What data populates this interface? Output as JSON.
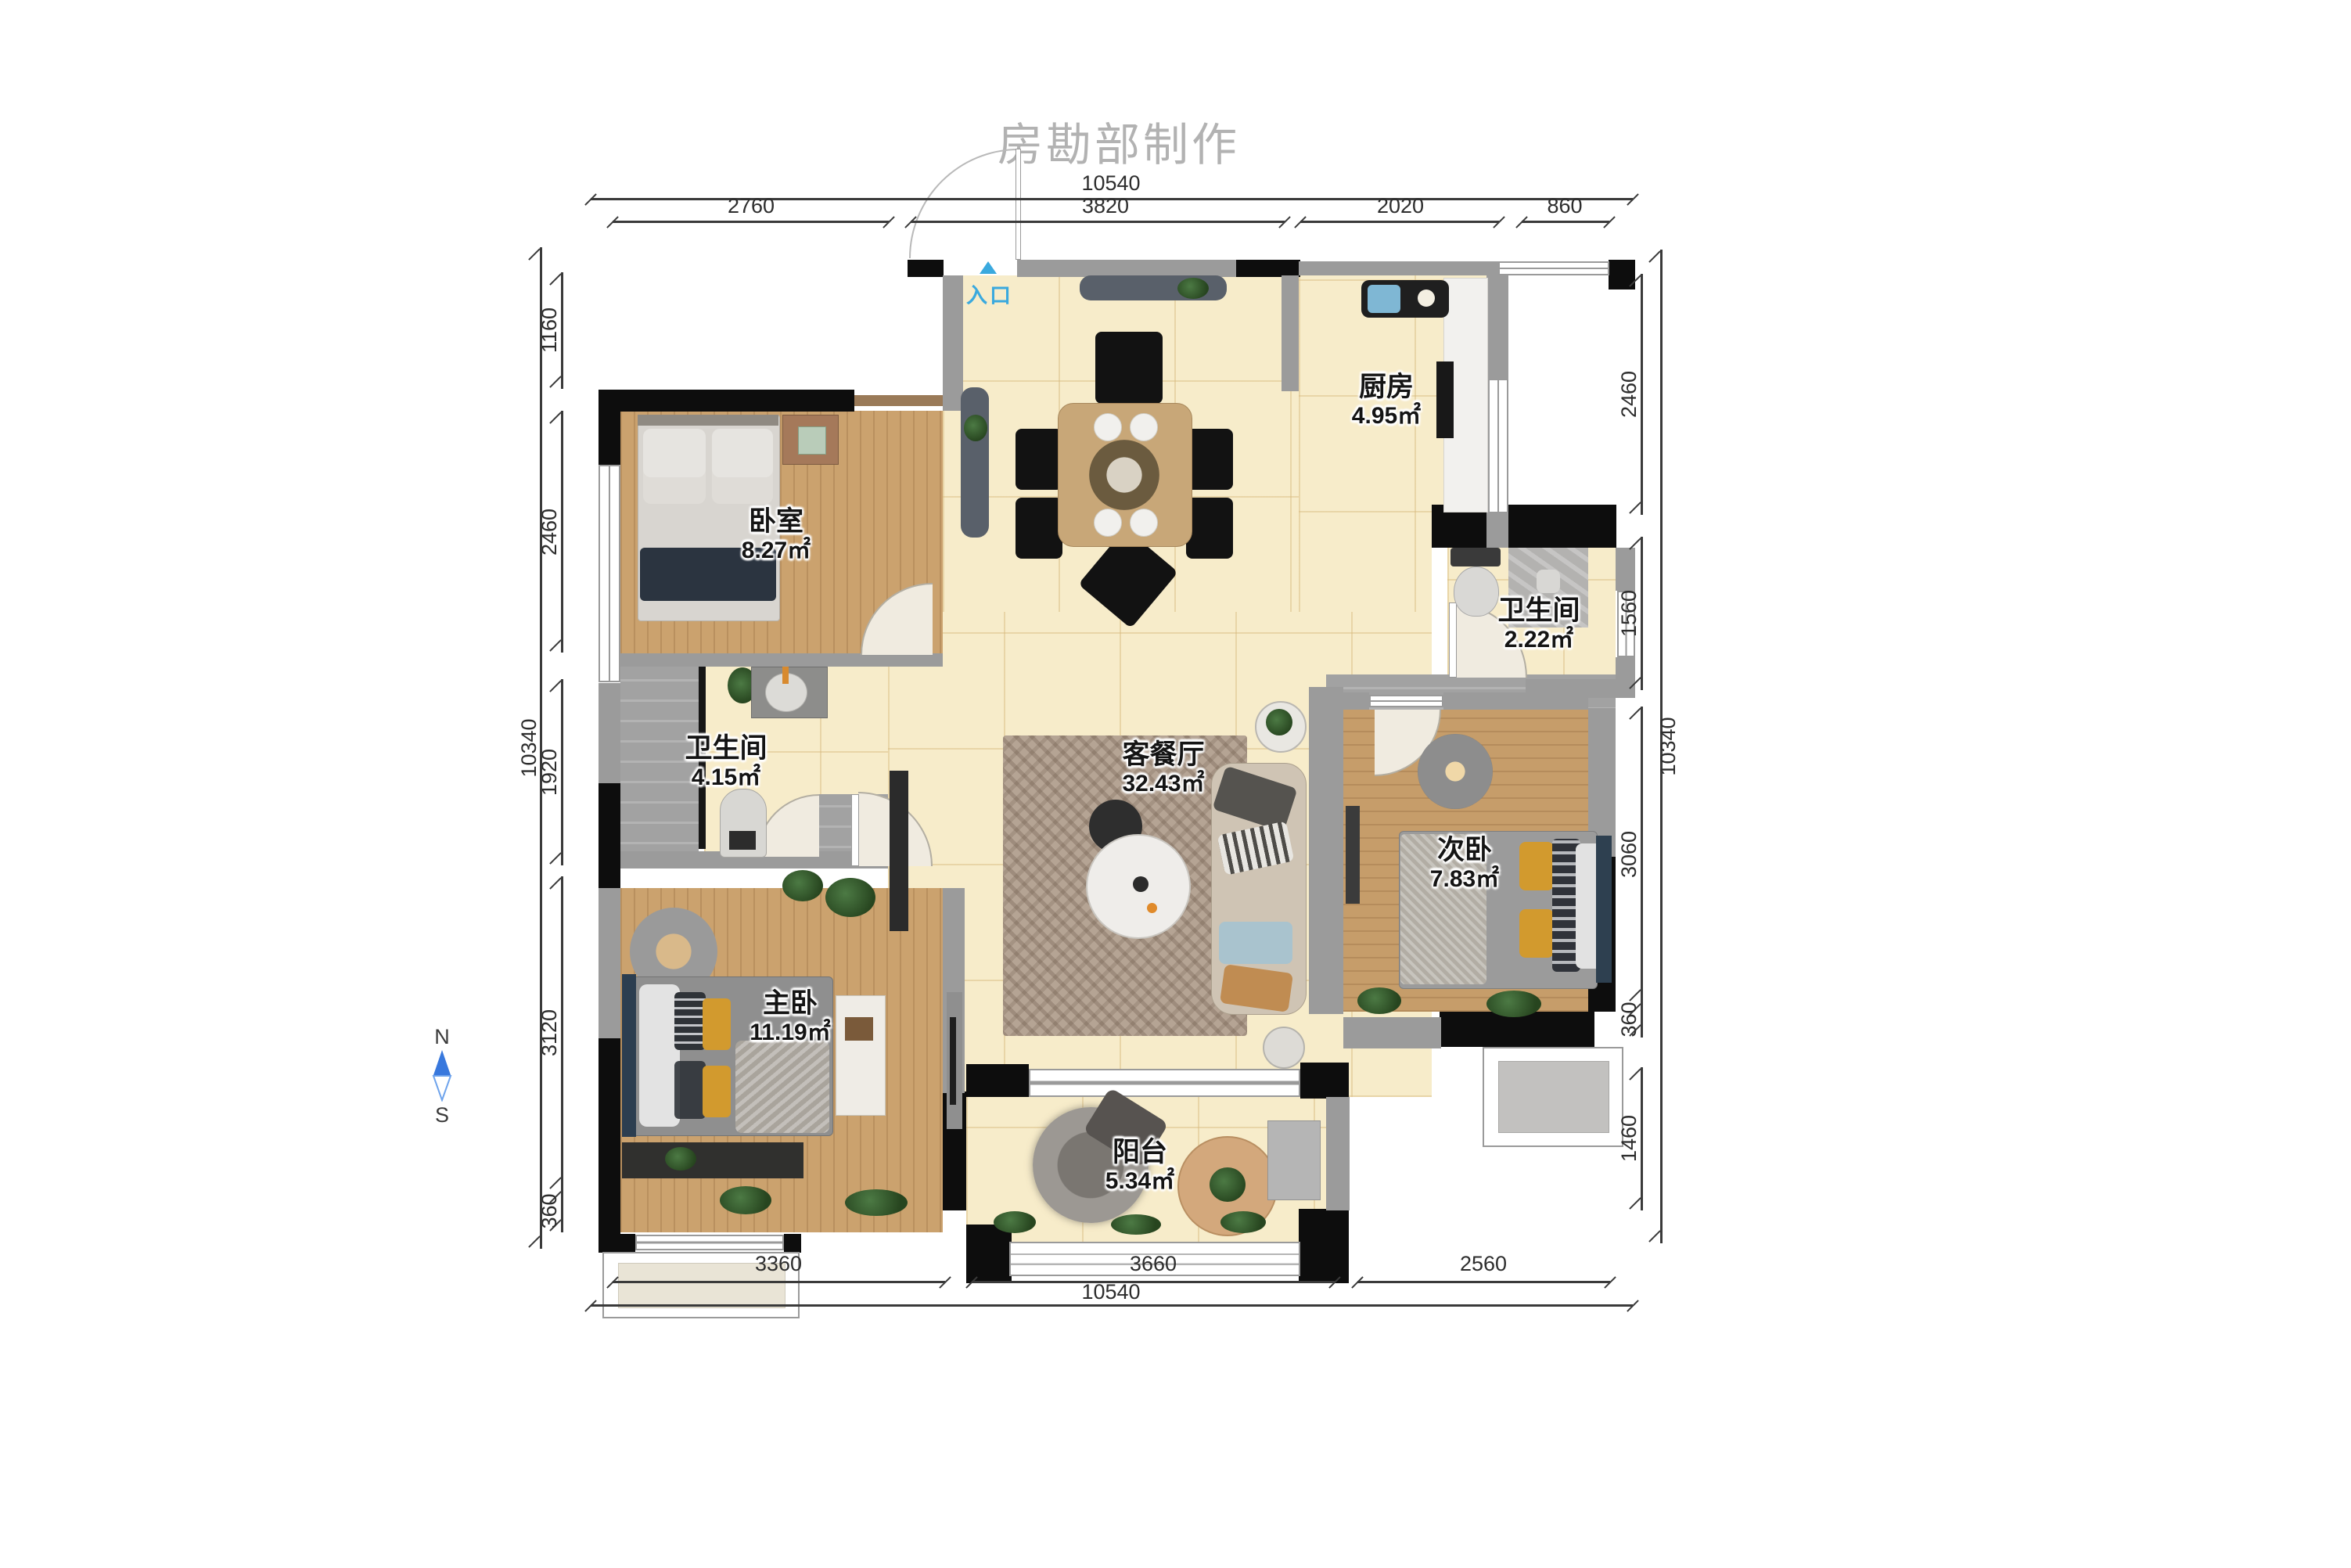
{
  "title": "房勘部制作",
  "entry": {
    "label": "入口"
  },
  "compass": {
    "north": "N",
    "south": "S"
  },
  "rooms": {
    "bedroom": {
      "name": "卧室",
      "area": "8.27㎡"
    },
    "kitchen": {
      "name": "厨房",
      "area": "4.95㎡"
    },
    "bath_right": {
      "name": "卫生间",
      "area": "2.22㎡"
    },
    "bath_left": {
      "name": "卫生间",
      "area": "4.15㎡"
    },
    "living": {
      "name": "客餐厅",
      "area": "32.43㎡"
    },
    "second_bedroom": {
      "name": "次卧",
      "area": "7.83㎡"
    },
    "master_bedroom": {
      "name": "主卧",
      "area": "11.19㎡"
    },
    "balcony": {
      "name": "阳台",
      "area": "5.34㎡"
    }
  },
  "dimensions": {
    "top": {
      "total": "10540",
      "segments": [
        "2760",
        "3820",
        "2020",
        "860"
      ]
    },
    "bottom": {
      "total": "10540",
      "segments": [
        "3360",
        "3660",
        "2560"
      ]
    },
    "left": {
      "total": "10340",
      "segments": [
        "1160",
        "2460",
        "1920",
        "3120",
        "360"
      ]
    },
    "right": {
      "total": "10340",
      "segments": [
        "2460",
        "1560",
        "3060",
        "360",
        "1460"
      ]
    }
  },
  "colors": {
    "accent_blue": "#3aa9de",
    "compass_blue": "#3878dd",
    "wall_black": "#0d0d0d",
    "wall_gray": "#9b9b9b",
    "tile_cream": "#f7ecca",
    "wood": "#cba26e"
  }
}
